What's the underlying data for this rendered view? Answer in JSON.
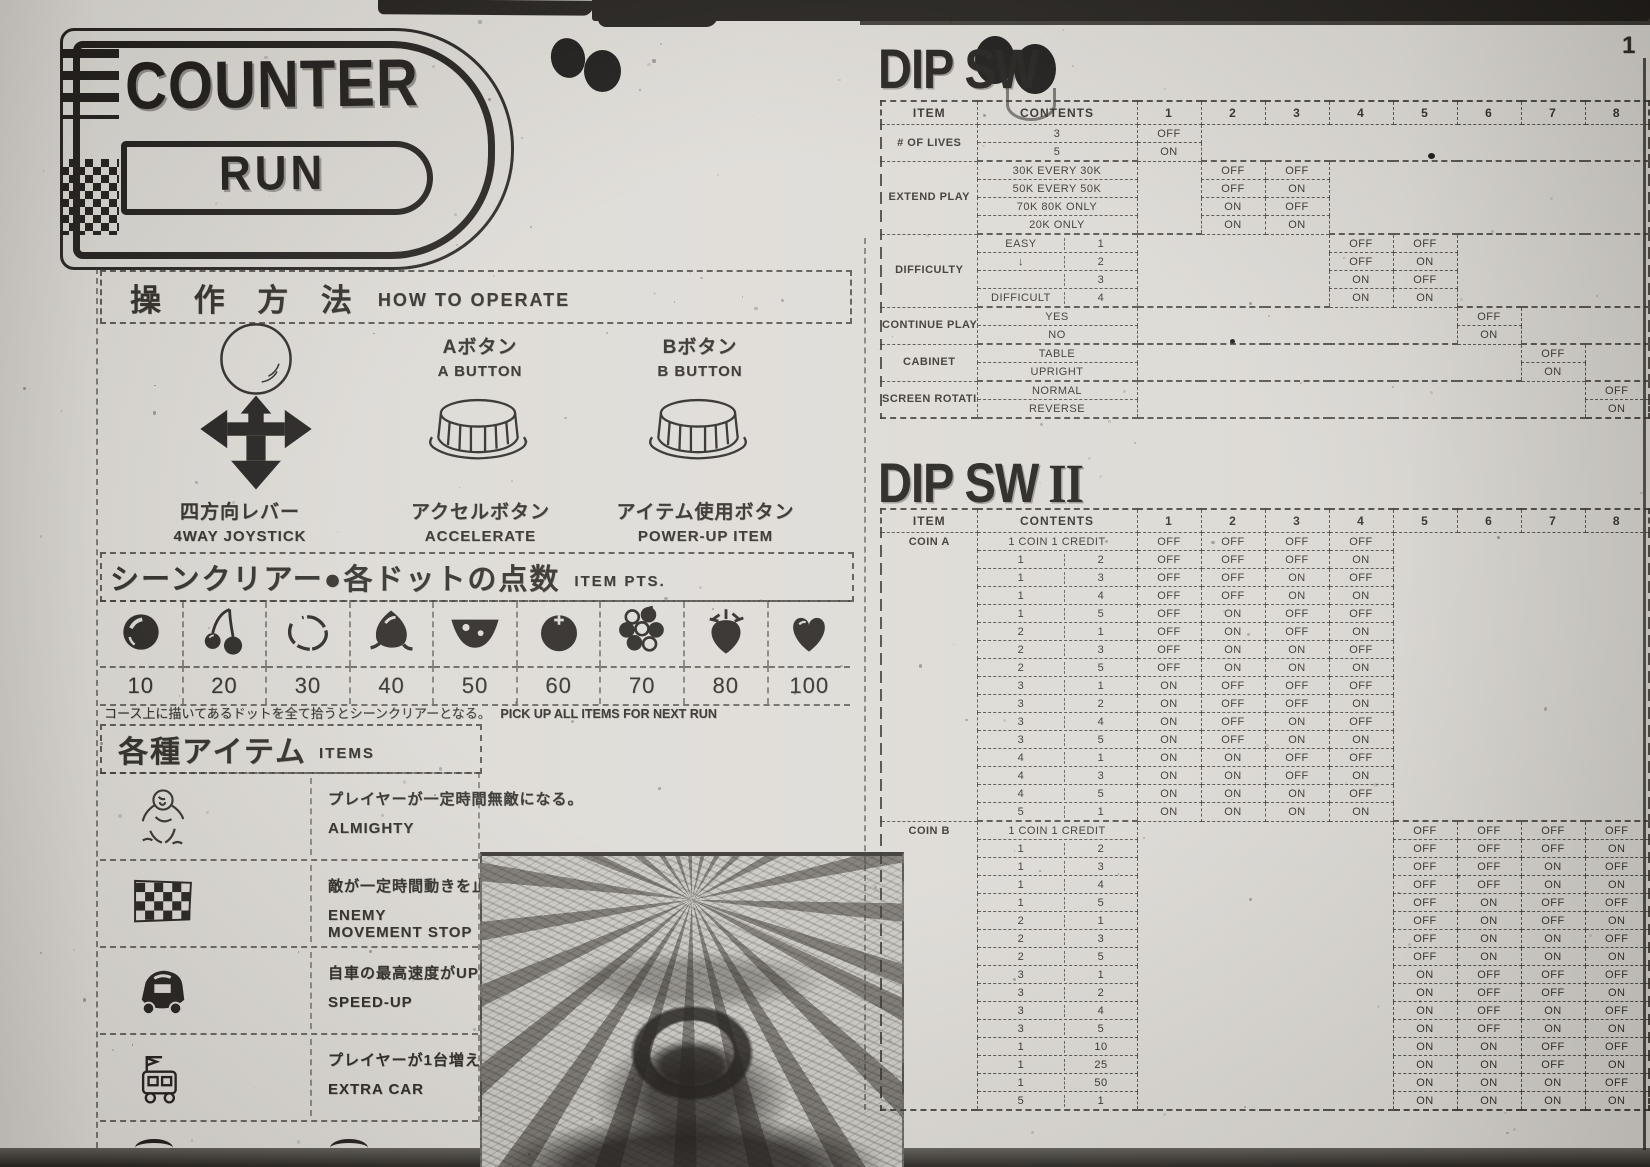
{
  "page": {
    "logo_line1": "COUNTER",
    "logo_line2": "RUN",
    "corner_mark": "1"
  },
  "operate": {
    "title_jp": "操 作 方 法",
    "title_en": "HOW TO OPERATE",
    "a_button_jp": "Aボタン",
    "a_button_en": "A BUTTON",
    "b_button_jp": "Bボタン",
    "b_button_en": "B BUTTON",
    "joystick_jp": "四方向レバー",
    "joystick_en": "4WAY JOYSTICK",
    "accel_jp": "アクセルボタン",
    "accel_en": "ACCELERATE",
    "item_jp": "アイテム使用ボタン",
    "item_en": "POWER-UP ITEM"
  },
  "item_pts": {
    "title_jp": "シーンクリアー●各ドットの点数",
    "title_en": "ITEM PTS.",
    "note_jp": "コース上に描いてあるドットを全て拾うとシーンクリアーとなる。",
    "note_en": "PICK UP ALL ITEMS FOR NEXT RUN",
    "items": [
      {
        "icon": "dot",
        "points": "10"
      },
      {
        "icon": "cherry",
        "points": "20"
      },
      {
        "icon": "lemon",
        "points": "30"
      },
      {
        "icon": "chestnut",
        "points": "40"
      },
      {
        "icon": "watermelon",
        "points": "50"
      },
      {
        "icon": "orange",
        "points": "60"
      },
      {
        "icon": "grapes",
        "points": "70"
      },
      {
        "icon": "strawberry",
        "points": "80"
      },
      {
        "icon": "heart",
        "points": "100"
      }
    ]
  },
  "items_section": {
    "title_jp": "各種アイテム",
    "title_en": "ITEMS",
    "rows": [
      {
        "icon": "almighty",
        "desc_jp": "プレイヤーが一定時間無敵になる。",
        "desc_en": "ALMIGHTY"
      },
      {
        "icon": "checkered-flag",
        "desc_jp": "敵が一定時間動きを止める。",
        "desc_en": "ENEMY MOVEMENT STOP"
      },
      {
        "icon": "speed-up-car",
        "desc_jp": "自車の最高速度がUPする。",
        "desc_en": "SPEED-UP"
      },
      {
        "icon": "extra-car",
        "desc_jp": "プレイヤーが1台増える。",
        "desc_en": "EXTRA CAR"
      }
    ]
  },
  "dipsw1": {
    "title": "DIP SW",
    "headers": [
      "ITEM",
      "CONTENTS",
      "1",
      "2",
      "3",
      "4",
      "5",
      "6",
      "7",
      "8"
    ],
    "groups": [
      {
        "item": "# OF LIVES",
        "rows": [
          {
            "content": "3",
            "sw": {
              "1": "OFF"
            }
          },
          {
            "content": "5",
            "sw": {
              "1": "ON"
            }
          }
        ]
      },
      {
        "item": "EXTEND PLAY",
        "rows": [
          {
            "content": "30K EVERY 30K",
            "sw": {
              "2": "OFF",
              "3": "OFF"
            }
          },
          {
            "content": "50K EVERY 50K",
            "sw": {
              "2": "OFF",
              "3": "ON"
            }
          },
          {
            "content": "70K 80K ONLY",
            "sw": {
              "2": "ON",
              "3": "OFF"
            }
          },
          {
            "content": "20K ONLY",
            "sw": {
              "2": "ON",
              "3": "ON"
            }
          }
        ]
      },
      {
        "item": "DIFFICULTY",
        "rows": [
          {
            "content": [
              "EASY",
              "1"
            ],
            "sw": {
              "4": "OFF",
              "5": "OFF"
            }
          },
          {
            "content": [
              "↓",
              "2"
            ],
            "sw": {
              "4": "OFF",
              "5": "ON"
            }
          },
          {
            "content": [
              "",
              "3"
            ],
            "sw": {
              "4": "ON",
              "5": "OFF"
            }
          },
          {
            "content": [
              "DIFFICULT",
              "4"
            ],
            "sw": {
              "4": "ON",
              "5": "ON"
            }
          }
        ]
      },
      {
        "item": "CONTINUE PLAY",
        "rows": [
          {
            "content": "YES",
            "sw": {
              "6": "OFF"
            }
          },
          {
            "content": "NO",
            "sw": {
              "6": "ON"
            }
          }
        ]
      },
      {
        "item": "CABINET",
        "rows": [
          {
            "content": "TABLE",
            "sw": {
              "7": "OFF"
            }
          },
          {
            "content": "UPRIGHT",
            "sw": {
              "7": "ON"
            }
          }
        ]
      },
      {
        "item": "SCREEN ROTATION",
        "rows": [
          {
            "content": "NORMAL",
            "sw": {
              "8": "OFF"
            }
          },
          {
            "content": "REVERSE",
            "sw": {
              "8": "ON"
            }
          }
        ]
      }
    ]
  },
  "dipsw2": {
    "title": "DIP SW",
    "numeral": "II",
    "headers": [
      "ITEM",
      "CONTENTS",
      "1",
      "2",
      "3",
      "4",
      "5",
      "6",
      "7",
      "8"
    ],
    "groups": [
      {
        "item": "COIN A",
        "vtop": true,
        "rows": [
          {
            "content": "1 COIN 1 CREDIT",
            "sw": {
              "1": "OFF",
              "2": "OFF",
              "3": "OFF",
              "4": "OFF"
            }
          },
          {
            "content": [
              "1",
              "2"
            ],
            "sw": {
              "1": "OFF",
              "2": "OFF",
              "3": "OFF",
              "4": "ON"
            }
          },
          {
            "content": [
              "1",
              "3"
            ],
            "sw": {
              "1": "OFF",
              "2": "OFF",
              "3": "ON",
              "4": "OFF"
            }
          },
          {
            "content": [
              "1",
              "4"
            ],
            "sw": {
              "1": "OFF",
              "2": "OFF",
              "3": "ON",
              "4": "ON"
            }
          },
          {
            "content": [
              "1",
              "5"
            ],
            "sw": {
              "1": "OFF",
              "2": "ON",
              "3": "OFF",
              "4": "OFF"
            }
          },
          {
            "content": [
              "2",
              "1"
            ],
            "sw": {
              "1": "OFF",
              "2": "ON",
              "3": "OFF",
              "4": "ON"
            }
          },
          {
            "content": [
              "2",
              "3"
            ],
            "sw": {
              "1": "OFF",
              "2": "ON",
              "3": "ON",
              "4": "OFF"
            }
          },
          {
            "content": [
              "2",
              "5"
            ],
            "sw": {
              "1": "OFF",
              "2": "ON",
              "3": "ON",
              "4": "ON"
            }
          },
          {
            "content": [
              "3",
              "1"
            ],
            "sw": {
              "1": "ON",
              "2": "OFF",
              "3": "OFF",
              "4": "OFF"
            }
          },
          {
            "content": [
              "3",
              "2"
            ],
            "sw": {
              "1": "ON",
              "2": "OFF",
              "3": "OFF",
              "4": "ON"
            }
          },
          {
            "content": [
              "3",
              "4"
            ],
            "sw": {
              "1": "ON",
              "2": "OFF",
              "3": "ON",
              "4": "OFF"
            }
          },
          {
            "content": [
              "3",
              "5"
            ],
            "sw": {
              "1": "ON",
              "2": "OFF",
              "3": "ON",
              "4": "ON"
            }
          },
          {
            "content": [
              "4",
              "1"
            ],
            "sw": {
              "1": "ON",
              "2": "ON",
              "3": "OFF",
              "4": "OFF"
            }
          },
          {
            "content": [
              "4",
              "3"
            ],
            "sw": {
              "1": "ON",
              "2": "ON",
              "3": "OFF",
              "4": "ON"
            }
          },
          {
            "content": [
              "4",
              "5"
            ],
            "sw": {
              "1": "ON",
              "2": "ON",
              "3": "ON",
              "4": "OFF"
            }
          },
          {
            "content": [
              "5",
              "1"
            ],
            "sw": {
              "1": "ON",
              "2": "ON",
              "3": "ON",
              "4": "ON"
            }
          }
        ]
      },
      {
        "item": "COIN B",
        "vtop": true,
        "rows": [
          {
            "content": "1 COIN 1 CREDIT",
            "sw": {
              "5": "OFF",
              "6": "OFF",
              "7": "OFF",
              "8": "OFF"
            }
          },
          {
            "content": [
              "1",
              "2"
            ],
            "sw": {
              "5": "OFF",
              "6": "OFF",
              "7": "OFF",
              "8": "ON"
            }
          },
          {
            "content": [
              "1",
              "3"
            ],
            "sw": {
              "5": "OFF",
              "6": "OFF",
              "7": "ON",
              "8": "OFF"
            }
          },
          {
            "content": [
              "1",
              "4"
            ],
            "sw": {
              "5": "OFF",
              "6": "OFF",
              "7": "ON",
              "8": "ON"
            }
          },
          {
            "content": [
              "1",
              "5"
            ],
            "sw": {
              "5": "OFF",
              "6": "ON",
              "7": "OFF",
              "8": "OFF"
            }
          },
          {
            "content": [
              "2",
              "1"
            ],
            "sw": {
              "5": "OFF",
              "6": "ON",
              "7": "OFF",
              "8": "ON"
            }
          },
          {
            "content": [
              "2",
              "3"
            ],
            "sw": {
              "5": "OFF",
              "6": "ON",
              "7": "ON",
              "8": "OFF"
            }
          },
          {
            "content": [
              "2",
              "5"
            ],
            "sw": {
              "5": "OFF",
              "6": "ON",
              "7": "ON",
              "8": "ON"
            }
          },
          {
            "content": [
              "3",
              "1"
            ],
            "sw": {
              "5": "ON",
              "6": "OFF",
              "7": "OFF",
              "8": "OFF"
            }
          },
          {
            "content": [
              "3",
              "2"
            ],
            "sw": {
              "5": "ON",
              "6": "OFF",
              "7": "OFF",
              "8": "ON"
            }
          },
          {
            "content": [
              "3",
              "4"
            ],
            "sw": {
              "5": "ON",
              "6": "OFF",
              "7": "ON",
              "8": "OFF"
            }
          },
          {
            "content": [
              "3",
              "5"
            ],
            "sw": {
              "5": "ON",
              "6": "OFF",
              "7": "ON",
              "8": "ON"
            }
          },
          {
            "content": [
              "1",
              "10"
            ],
            "sw": {
              "5": "ON",
              "6": "ON",
              "7": "OFF",
              "8": "OFF"
            }
          },
          {
            "content": [
              "1",
              "25"
            ],
            "sw": {
              "5": "ON",
              "6": "ON",
              "7": "OFF",
              "8": "ON"
            }
          },
          {
            "content": [
              "1",
              "50"
            ],
            "sw": {
              "5": "ON",
              "6": "ON",
              "7": "ON",
              "8": "OFF"
            }
          },
          {
            "content": [
              "5",
              "1"
            ],
            "sw": {
              "5": "ON",
              "6": "ON",
              "7": "ON",
              "8": "ON"
            }
          }
        ]
      }
    ]
  }
}
